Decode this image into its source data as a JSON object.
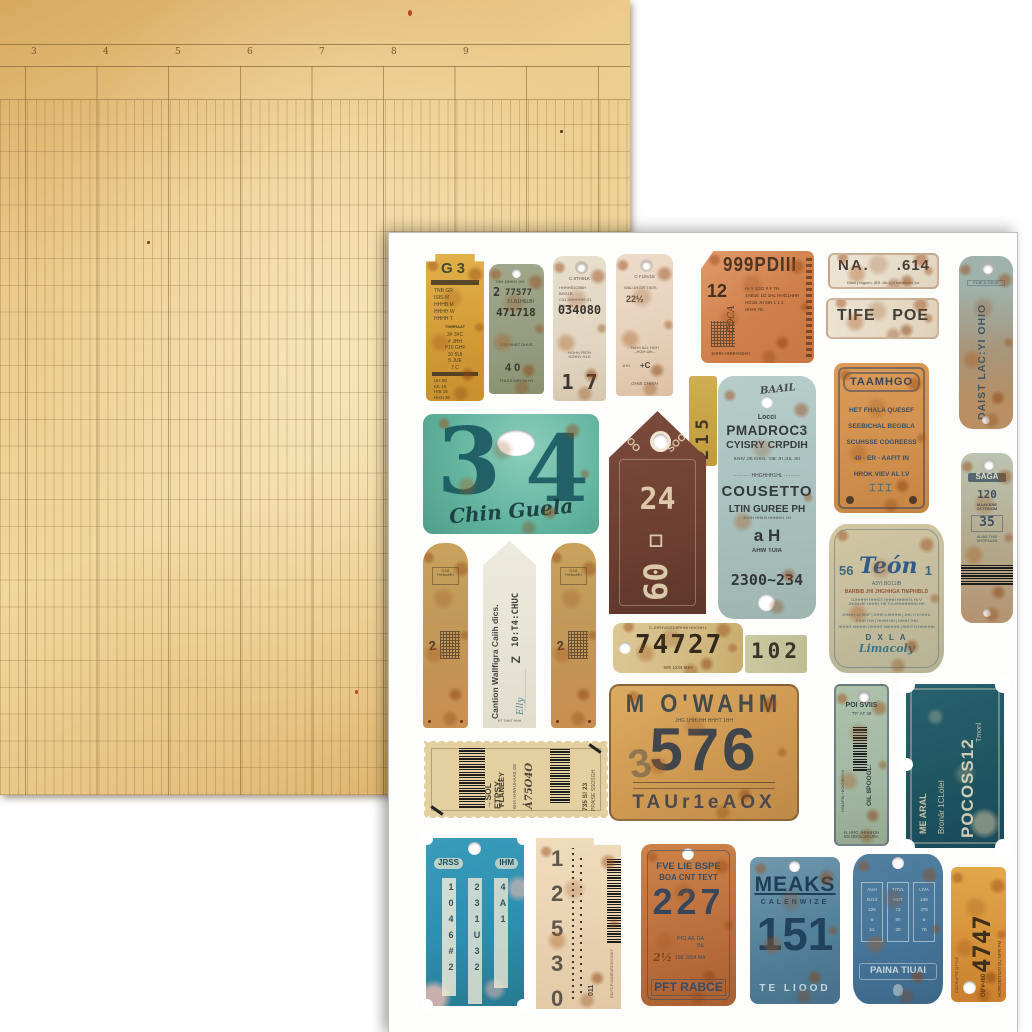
{
  "ledger": {
    "column_numbers": [
      "3",
      "4",
      "5",
      "6",
      "7",
      "8",
      "9"
    ]
  },
  "colors": {
    "ledger_paper": "#eccb8c",
    "ledger_line": "#76542c",
    "sheet": "#fdfdfb",
    "teal_plate": "#63b5a0",
    "rust_orange": "#c06a35",
    "dark_teal_ticket": "#215c68",
    "mustard": "#d2a041",
    "denim_blue": "#2d8fb0"
  },
  "tags": {
    "g3": {
      "title": "G3",
      "bar": "IHI DHRIGHN DNTBF",
      "block1": "TNB    GR\nISIS    M\nHHHB    M\nHHHH    W\nHHHH    T",
      "mid": "TIHRRAAT",
      "block2": "3#  3#C\n#  JHH\nP10  GHF\n10  5UI\n5  JUE\n7  C",
      "bar2": "HTTIJIHG PHH1BF",
      "block3": "UH    5E\nKK    10\nHIB    15\nHHH    30"
    },
    "green": {
      "head": "THH 1HHH1 HH",
      "num": "2",
      "serial": "77577",
      "sub": "3 LB1H6LBI",
      "serial2": "471718",
      "note": "C3Y  HHBT DHUS",
      "stamp": "4 0",
      "foot": "THLE5 W5Y GLHY"
    },
    "cream": {
      "head": "C 8TH91K",
      "block": "HHHHB3CB6H\nBHG1B\nC31 DHrHH3H G1 DHmgH",
      "serial": "034080",
      "mid": "HGHH FB7H\nHJHH1 H1H",
      "digits": "1    7"
    },
    "pink": {
      "head": "C F18V18",
      "label": "W8LGH DR T8GS",
      "num": "22½",
      "mid": "TwHS ALL HGH\n→HGH ΩH←",
      "stamp": "+C",
      "side": "1HH",
      "foot": "GHIB        CHHIH"
    },
    "ticket999": {
      "title": "999PDIII",
      "num": "12",
      "script": "COCA",
      "block": "HI Y 1GG    # # 7H\n1HB1E  1G 1HL  HHG1HHH\nHG1B  JH 5IH    1 1 1\nHHHI YE.",
      "foot": "1HHH HHHHH1HH"
    },
    "na614": {
      "left": "NA.",
      "right": ".614",
      "sub": "Blani   |  raguen. |BS .Ab |QI|  bonsbone jot."
    },
    "tife": {
      "left": "TIFE",
      "right": "POE"
    },
    "taamhgo": {
      "title": "TAAMHGO",
      "lines": "HET FHALA  QUESEF\nSEEBICHAL  BEGBLA\nSCUHSSE  COGREESS\n49 - ER - AAFIT  IN\nHROK  VIEV  AL I.V",
      "figures": "⌶⌶⌶"
    },
    "daist": {
      "top": "FUIE N CEUE",
      "vertical": "DAIST LAC:YI OHIO"
    },
    "label215": {
      "digits": "215"
    },
    "plate34": {
      "d1": "3",
      "d2": "4",
      "script": "Chin Guela"
    },
    "tag2460": {
      "arc_left": "HOO",
      "arc_right": "SOOSA",
      "num": "24",
      "num2": "60▫"
    },
    "pmadroc": {
      "script": "BAAIL",
      "small": "Locci",
      "line1": "PMADROC3",
      "line2": "CYISRY CRPDIH",
      "cols": "84HV JIB  KHHL.      'HB' JH  JHL JIH",
      "dotted": "·········· HHGHHH1HL ··········",
      "line3": "COUSETTO",
      "line4": "LTIN GUREE PH",
      "tiny": "JHGH HH6 B HHHHH1 1H",
      "line5": "a  H",
      "line6": "AHW  TUIA",
      "line7": "2300~234"
    },
    "teon": {
      "pre": "56",
      "script": "Teón",
      "post": "1",
      "sub": "A3YI                 BO11IB",
      "band": "BARBIB JHI JHGHHGA TIMPHIBLD",
      "small": "GJHHHH HHHGT HHHH HHHHTL HI V\nJHGH HE HHHH. HE T.H HHHHHHHH.HH",
      "cells": "JHHHH 1A HHIF | JHHE A HHHHH | JHC H H HHHL\nJHHH THH | HHHH HH | HHHH THH\nHHHHT HHHHH | HHHHT HHHHHL | HHHT H HHHHHH",
      "dxla": "D X L A",
      "script2": "Limacoly"
    },
    "saga": {
      "title": "SAGA",
      "num1": "120",
      "label1": "MAAKENE\nOCTRNOM",
      "num2": "35",
      "label2": "ALIAS THIS\nSHOPSAAR"
    },
    "stripL": {
      "badge": "GJrA HrHswHlH",
      "num": "2"
    },
    "stripR": {
      "badge": "GJrA HrHswHlH",
      "num": "2"
    },
    "caution": {
      "v1": "Cantion Wallfigra Caiih dics.",
      "v2": "10:T4:CHUC",
      "z": "Z",
      "dots": "·····················",
      "script": "Elly",
      "foot": "HT THHT HHH"
    },
    "plate74727": {
      "top": "G.JHFHVGG3 BRHNI HGCHH L",
      "num": "74727",
      "bottom": "905  1234  5HH"
    },
    "label102": {
      "num": "102"
    },
    "mowahm": {
      "title": "M O'WAHM",
      "small": "JHG  1HHI  HH  HHHT 1HH",
      "ghost": "3",
      "num": "576",
      "bottom": "TAUr1eAOX"
    },
    "poi": {
      "top": "POI SVIIS",
      "sub": "'TF' AT 49",
      "vert": "OIL 8POOGL:",
      "vert2": "HIMAFBL+BOKHBOVH",
      "bottom": "H. HHG JHHHH1H\nES ODGL1BAJRA"
    },
    "pocoss": {
      "big": "POCOSS12",
      "mid": "Bronär 1CLoleI",
      "small": "Tmonl",
      "side": "ME ARAL"
    },
    "stamp": {
      "v1": "→SOL ETPSY-",
      "v2": "FLANEEY",
      "v3": "BHA HHVHJHAAS.GE",
      "script": "Ȧ75O4O",
      "v4": "735 S! 23",
      "v5": "PRAISE SSOSGH"
    },
    "jrss": {
      "label_l": "JRSS",
      "label_r": "IHM",
      "col1": "1046#2",
      "col2": "231U32",
      "col3": "4A1"
    },
    "strip12530": {
      "digits": "12530",
      "barcode_num": "011",
      "side": "BD/7CPUM4R4RDHV30A7"
    },
    "tag227": {
      "l1": "FVE  LIE  BSPE",
      "l2": "BOA CNT TEYT",
      "num": "227",
      "m1": "PIG  AE  DA",
      "m2": "B&",
      "m3": "2½",
      "m4": "19E  2804  MA",
      "foot": "PFT RABCE"
    },
    "meaks": {
      "title": "MEAKS",
      "sub": "CALENWIZE",
      "num": "151",
      "foot": "TE LIOOD"
    },
    "paina": {
      "col1": "AUH\n5U13\n226\n※\n10.",
      "col2": "TITVL\nHUT\n73\n8¤\n30",
      "col3": "LIVA\n249\n378\n※\n70",
      "banner": "PAINA TIUAI"
    },
    "strip4747": {
      "big": "4747",
      "side1": "CACHUPTE QTYLE",
      "side2": "HOIROBITION DU NPR PM",
      "small": "O9′#-/60"
    }
  }
}
